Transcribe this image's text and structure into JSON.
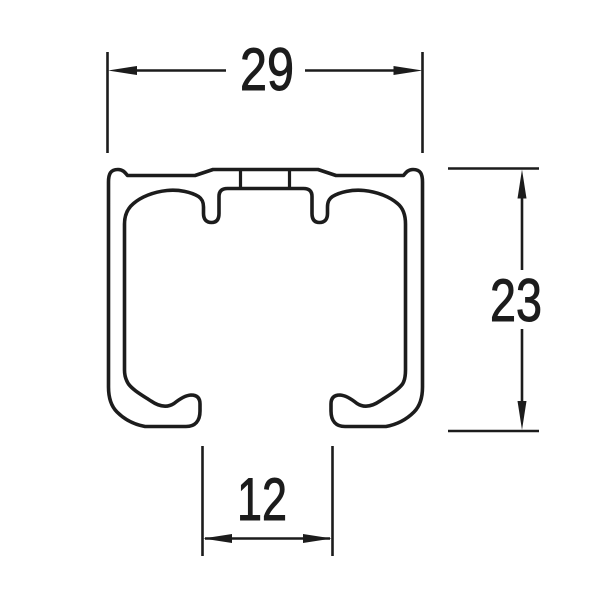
{
  "canvas": {
    "background_color": "#ffffff",
    "line_color": "#1c1c1c"
  },
  "figure": {
    "name": "rail-profile-cross-section"
  },
  "dimensions": {
    "top_width": {
      "label": "29",
      "orientation": "horizontal",
      "position": "top"
    },
    "right_height": {
      "label": "23",
      "orientation": "vertical",
      "position": "right"
    },
    "bottom_slot": {
      "label": "12",
      "orientation": "horizontal",
      "position": "bottom"
    }
  }
}
